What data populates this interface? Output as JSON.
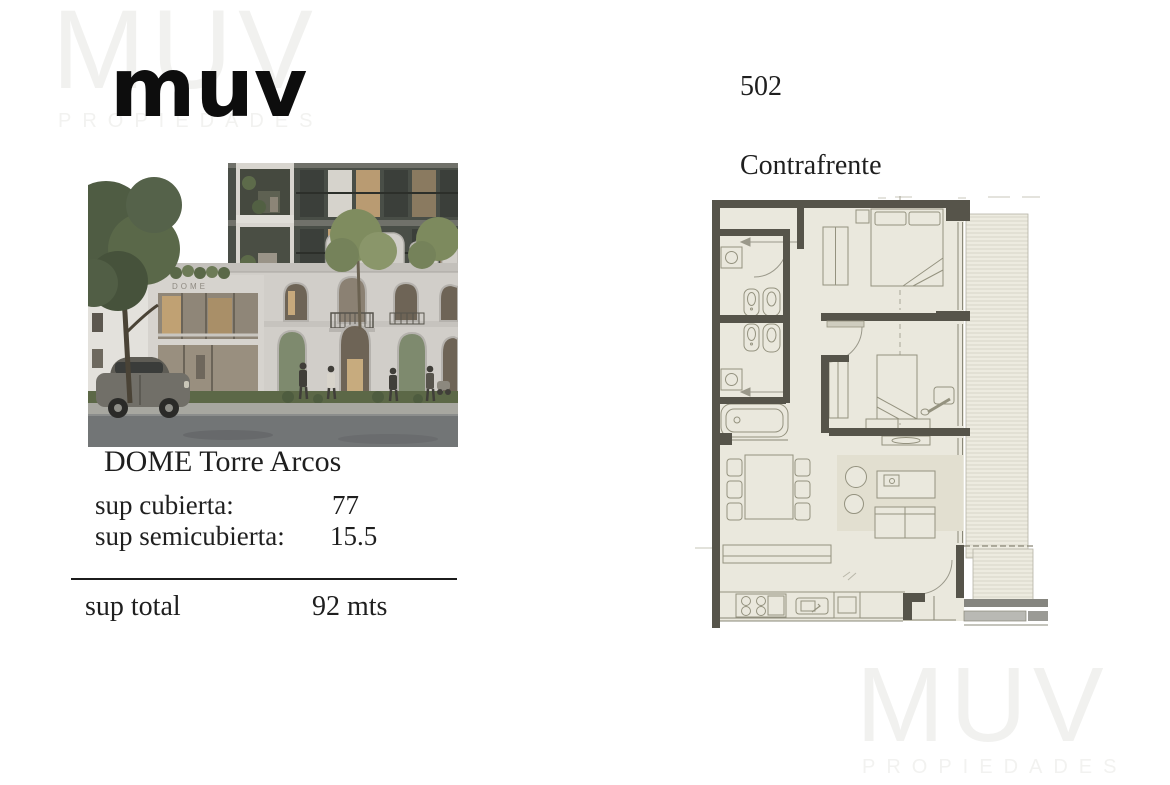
{
  "brand": {
    "logo_text": "muv",
    "watermark": {
      "line1": "MUV",
      "line2": "PROPIEDADES"
    }
  },
  "unit": {
    "number": "502",
    "orientation": "Contrafrente"
  },
  "project": {
    "name": "DOME Torre Arcos",
    "facade_sign": "DOME"
  },
  "specs": {
    "rows": [
      {
        "label": "sup cubierta:",
        "value": "77"
      },
      {
        "label": "sup semicubierta:",
        "value": "15.5"
      }
    ],
    "total_label": "sup total",
    "total_value": "92 mts"
  },
  "colors": {
    "text": "#1f1f1f",
    "watermark": "#f1f1ef",
    "plan_wall": "#56544a",
    "plan_floor": "#eae8dd",
    "plan_rug": "#e2dfd0",
    "plan_line": "#94927f",
    "facade": "#d1cec9",
    "tower_glass": "#494e47",
    "warm_window": "#c3a276",
    "street": "#727576",
    "grass": "#5c6847",
    "awning_red": "#a84a31"
  }
}
